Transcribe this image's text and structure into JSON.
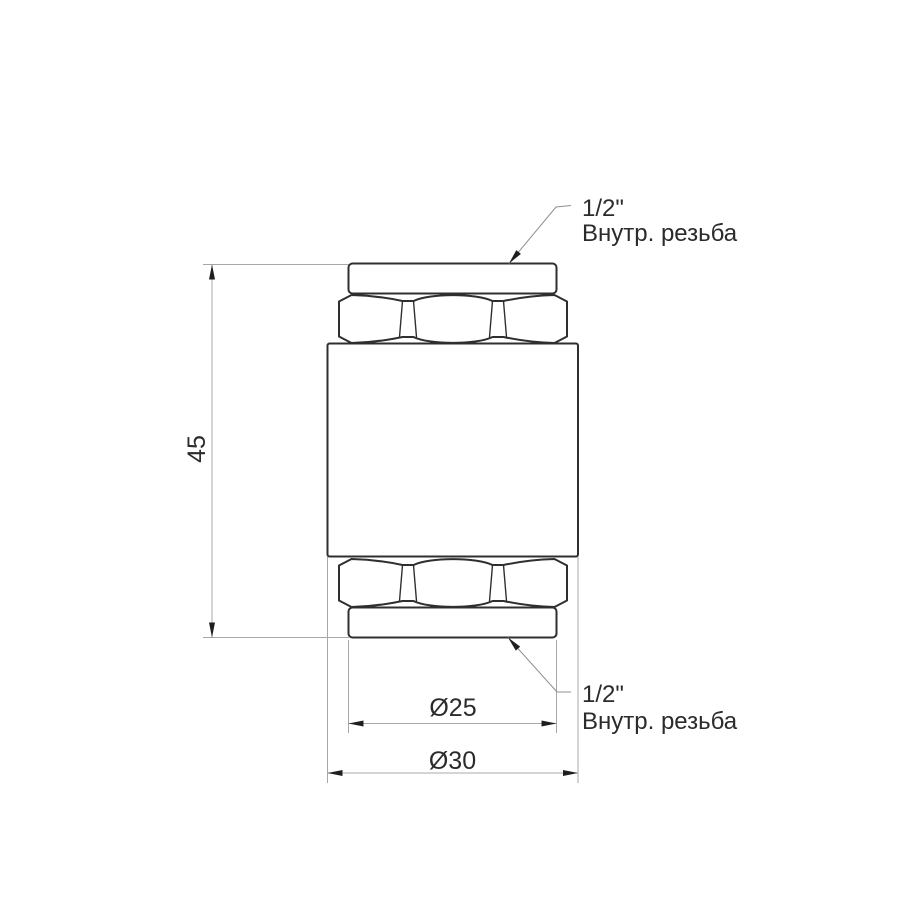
{
  "drawing": {
    "dim_height": "45",
    "dim_inner_diameter": "Ø25",
    "dim_outer_diameter": "Ø30",
    "thread_label_top": {
      "size": "1/2\"",
      "text": "Внутр. резьба"
    },
    "thread_label_bottom": {
      "size": "1/2\"",
      "text": "Внутр. резьба"
    },
    "colors": {
      "background": "#ffffff",
      "part_outline": "#2f2f2f",
      "dimension_line": "#a8a8a8",
      "leader_line": "#8f8f8f",
      "arrowhead": "#1f1f1f",
      "text": "#2b2b2b"
    }
  }
}
